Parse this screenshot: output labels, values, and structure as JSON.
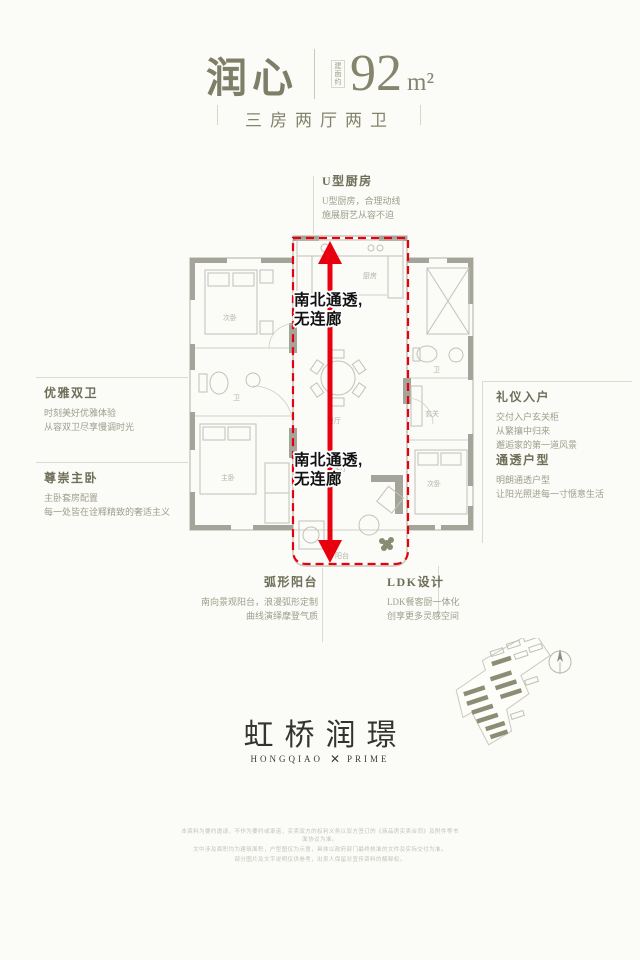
{
  "header": {
    "title": "润心",
    "area_note": "建面约",
    "area_value": "92",
    "area_unit": "m²",
    "subtitle": "三房两厅两卫"
  },
  "highlight": {
    "line1": "南北通透,",
    "line2": "无连廊"
  },
  "annotations": {
    "kitchen": {
      "title": "U型厨房",
      "line1": "U型厨房，合理动线",
      "line2": "施展厨艺从容不迫"
    },
    "baths": {
      "title": "优雅双卫",
      "line1": "时刻美好优雅体验",
      "line2": "从容双卫尽享慢调时光"
    },
    "master": {
      "title": "尊崇主卧",
      "line1": "主卧套房配置",
      "line2": "每一处皆在诠释精致的奢适主义"
    },
    "entry": {
      "title": "礼仪入户",
      "line1": "交付入户玄关柜",
      "line2": "从繁攘中归来",
      "line3": "邂逅家的第一道风景"
    },
    "transparent": {
      "title": "通透户型",
      "line1": "明朗通透户型",
      "line2": "让阳光照进每一寸惬意生活"
    },
    "balcony": {
      "title": "弧形阳台",
      "line1": "南向景观阳台，浪漫弧形定制",
      "line2": "曲线演绎摩登气质"
    },
    "ldk": {
      "title": "LDK设计",
      "line1": "LDK餐客厨一体化",
      "line2": "创享更多灵感空间"
    }
  },
  "plan": {
    "rooms": [
      "次卧",
      "卫",
      "主卧",
      "厨房",
      "餐厅",
      "客厅",
      "阳台",
      "玄关",
      "卫",
      "次卧"
    ]
  },
  "logo": {
    "cn": "虹桥润璟",
    "en_left": "HONGQIAO",
    "en_mark": "✕",
    "en_right": "PRIME"
  },
  "disclaimer": {
    "line1": "本资料为要约邀请，不作为要约或承诺，买卖双方的权利义务以双方签订的《商品房买卖合同》及附件等书面协议为准。",
    "line2": "文中涉及面积均为建筑面积，户型图仅为示意，具体以政府部门最终核准的文件及实际交付为准。",
    "line3": "部分图片及文字说明仅供参考，出卖人保留对宣传资料的解释权。"
  },
  "colors": {
    "accent_red": "#e8000e",
    "olive": "#82826a",
    "wall_grey": "#a4a49a",
    "ink": "#333331"
  }
}
